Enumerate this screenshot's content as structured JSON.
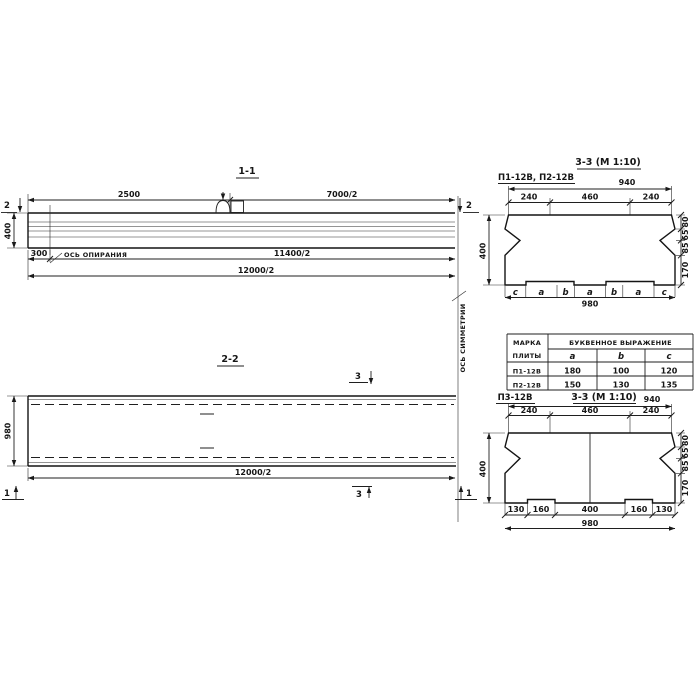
{
  "section_1_1": {
    "title": "1-1",
    "cut_marker": "2",
    "dim_top_left": "2500",
    "dim_top_right": "7000/2",
    "dim_height": "400",
    "dim_support_offset": "300",
    "dim_bearing_half": "11400/2",
    "dim_length_half": "12000/2",
    "support_axis_label": "ОСЬ ОПИРАНИЯ"
  },
  "symmetry_axis": {
    "label": "ОСЬ СИММЕТРИИ"
  },
  "section_2_2": {
    "title": "2-2",
    "cut_marker_3": "3",
    "cut_marker_1": "1",
    "dim_width": "980",
    "dim_length_half": "12000/2"
  },
  "section_3_3_upper": {
    "title": "3-3 (М 1:10)",
    "plates_label": "П1-12В, П2-12В",
    "dim_overall_top": "940",
    "dims_top": [
      "240",
      "460",
      "240"
    ],
    "dim_height": "400",
    "dims_right": [
      "80",
      "65",
      "85",
      "170"
    ],
    "letter_row": [
      "c",
      "a",
      "b",
      "a",
      "b",
      "a",
      "c"
    ],
    "dim_overall_bottom": "980"
  },
  "plates_table": {
    "header_mark_line1": "МАРКА",
    "header_mark_line2": "ПЛИТЫ",
    "header_expression": "БУКВЕННОЕ ВЫРАЖЕНИЕ",
    "columns": [
      "a",
      "b",
      "c"
    ],
    "rows": [
      {
        "mark": "П1-12В",
        "a": "180",
        "b": "100",
        "c": "120"
      },
      {
        "mark": "П2-12В",
        "a": "150",
        "b": "130",
        "c": "135"
      }
    ]
  },
  "section_3_3_lower": {
    "plate_label": "П3-12В",
    "title": "3-3 (М 1:10)",
    "dim_overall_top": "940",
    "dims_top": [
      "240",
      "460",
      "240"
    ],
    "dim_height": "400",
    "dims_right": [
      "80",
      "65",
      "85",
      "170"
    ],
    "dims_bottom": [
      "130",
      "160",
      "400",
      "160",
      "130"
    ],
    "dim_overall_bottom": "980"
  }
}
